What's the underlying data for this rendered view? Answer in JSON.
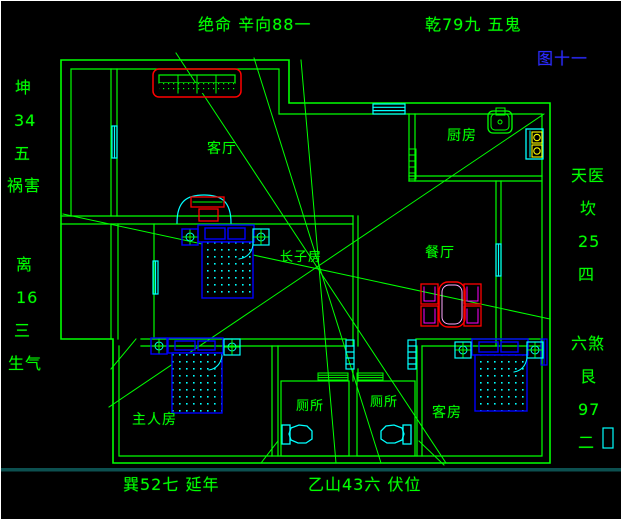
{
  "annotations": {
    "top_left": "绝命 辛向88一",
    "top_right": "乾79九 五鬼",
    "figure_label": "图十一",
    "bottom_left": "巽52七 延年",
    "bottom_right": "乙山43六 伏位",
    "left_upper": [
      "坤",
      "34",
      "五",
      "祸害"
    ],
    "left_lower": [
      "离",
      "16",
      "三",
      "生气"
    ],
    "right_upper": [
      "天医",
      "坎",
      "25",
      "四"
    ],
    "right_lower": [
      "六煞",
      "艮",
      "97",
      "二"
    ]
  },
  "rooms": {
    "living_room": "客厅",
    "kitchen": "厨房",
    "dining_room": "餐厅",
    "eldest_son_room": "长子房",
    "master_bedroom": "主人房",
    "toilet_left": "厕所",
    "toilet_right": "厕所",
    "guest_room": "客房"
  },
  "colors": {
    "background": "#000000",
    "wall_green": "#00ff00",
    "window_cyan": "#00ffff",
    "furniture_red": "#ff0000",
    "furniture_blue": "#0000ff",
    "accent_magenta": "#ff00ff",
    "burner_yellow": "#ffff00",
    "figure_label_blue": "#2a2aff"
  }
}
